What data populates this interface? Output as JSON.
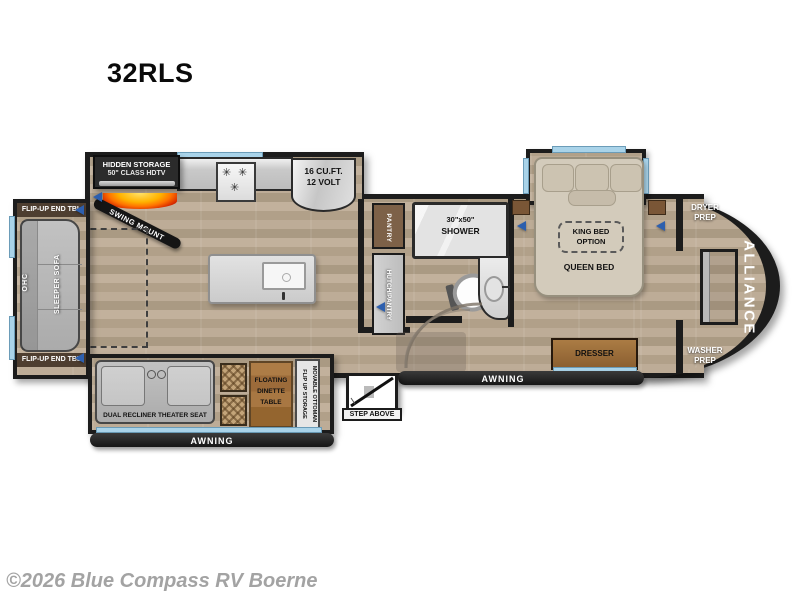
{
  "title": "32RLS",
  "copyright": "©2026 Blue Compass RV Boerne",
  "brand": "ALLIANCE",
  "icons": {
    "burner": "✳"
  },
  "living": {
    "tv_line1": "HIDDEN STORAGE",
    "tv_line2": "50\" CLASS HDTV",
    "swing_mount": "SWING MOUNT",
    "end_table_top": "FLIP-UP END TBL",
    "end_table_bottom": "FLIP-UP END TBL",
    "ohc": "OHC",
    "sofa": "SLEEPER SOFA",
    "theater_seat": "DUAL RECLINER THEATER SEAT",
    "dinette_line1": "FLOATING",
    "dinette_line2": "DINETTE",
    "dinette_line3": "TABLE",
    "ottoman_line1": "MOVABLE OTTOMAN",
    "ottoman_line2": "FLIP UP STORAGE",
    "awning": "AWNING"
  },
  "kitchen": {
    "fridge_line1": "16 CU.FT.",
    "fridge_line2": "12 VOLT",
    "pantry": "PANTRY",
    "hutch": "HUTCH/PANTRY"
  },
  "bath": {
    "shower_line1": "30\"x50\"",
    "shower_line2": "SHOWER"
  },
  "bedroom": {
    "king_line1": "KING BED",
    "king_line2": "OPTION",
    "queen": "QUEEN BED",
    "dresser": "DRESSER",
    "dryer_line1": "DRYER",
    "dryer_line2": "PREP",
    "washer_line1": "WASHER",
    "washer_line2": "PREP",
    "awning": "AWNING"
  },
  "entry": {
    "step": "STEP ABOVE"
  },
  "colors": {
    "wall": "#1c1c1c",
    "window": "#a9d3e9",
    "floor": "#b6a48e",
    "wood_furniture": "#9c6b40",
    "fireplace": "#ff7300",
    "speaker_arrow": "#2d5fae"
  }
}
